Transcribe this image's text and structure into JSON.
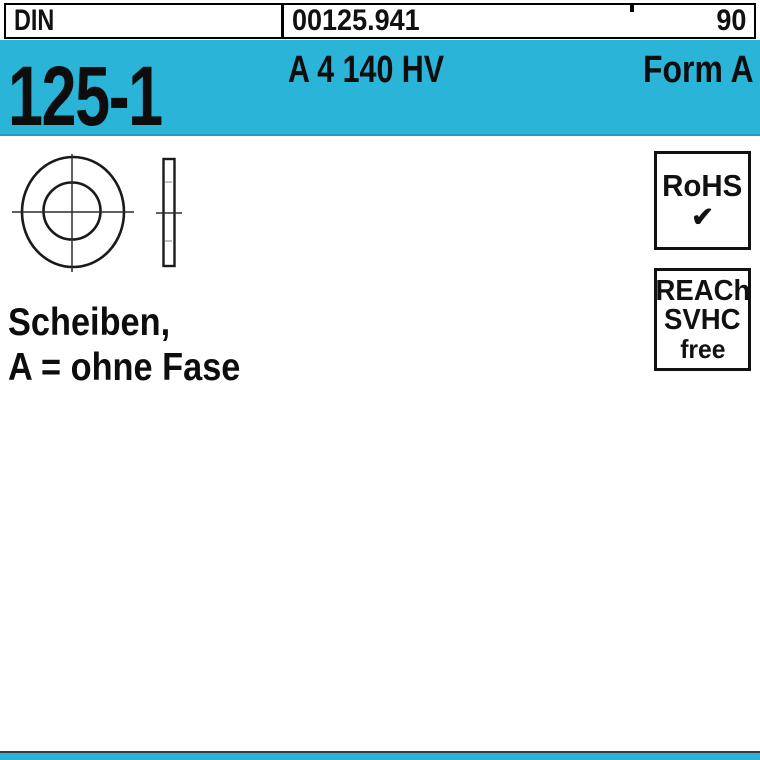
{
  "header": {
    "din_label": "DIN",
    "article_number": "00125.941",
    "page_number": "90"
  },
  "banner": {
    "standard_number": "125-1",
    "material_spec": "A 4 140 HV",
    "form_label": "Form A"
  },
  "badges": {
    "rohs_label": "RoHS",
    "rohs_check": "✔",
    "reach_lines": [
      "REACh",
      "SVHC",
      "free"
    ]
  },
  "description": {
    "line1": "Scheiben,",
    "line2": "A = ohne Fase"
  },
  "colors": {
    "accent_cyan": "#29b4d8",
    "banner_edge": "#1f9cbd",
    "ink": "#111111",
    "background": "#ffffff"
  }
}
